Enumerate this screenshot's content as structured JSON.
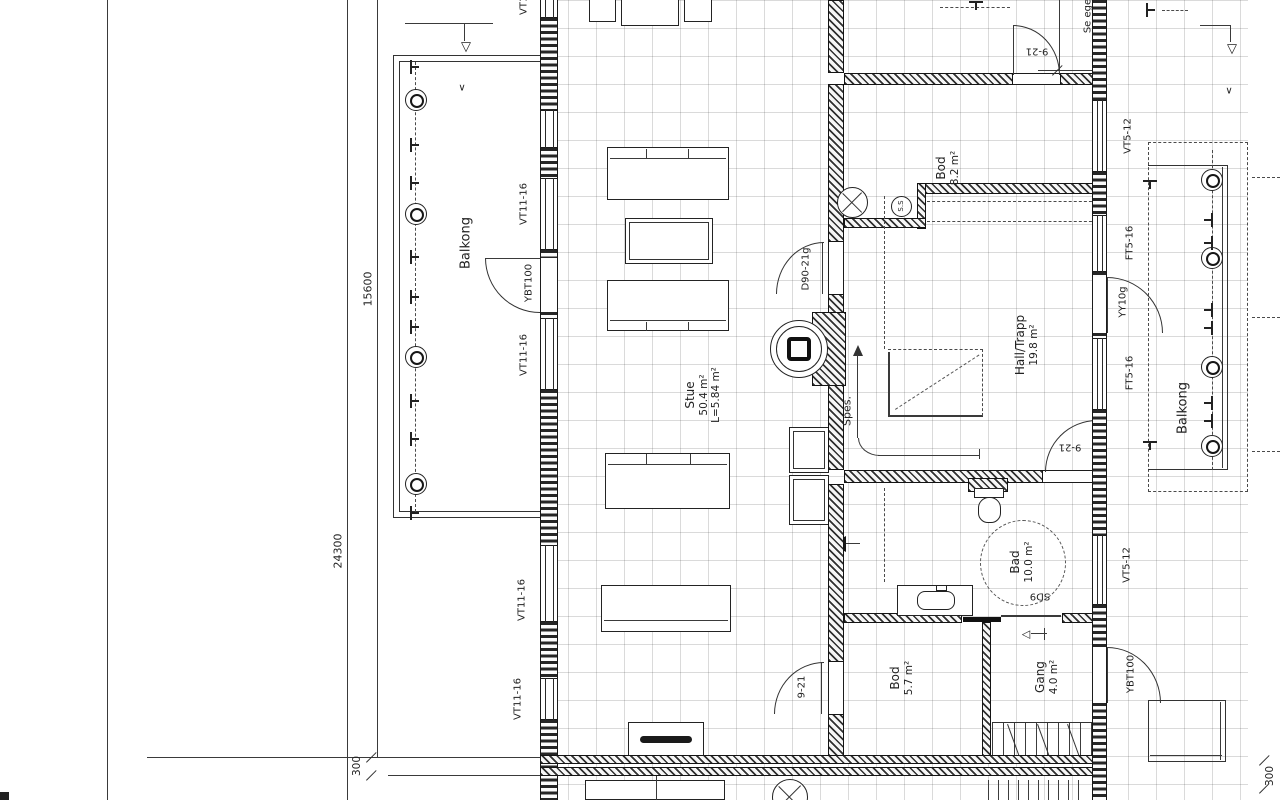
{
  "colors": {
    "ink": "#222222",
    "paper": "#ffffff"
  },
  "icons": {
    "section_triangle": "▽",
    "small_arrow": "∨",
    "entry_arrow": "◁"
  },
  "rooms": {
    "stue": {
      "name": "Stue",
      "area": "50.4 m²",
      "length": "L=5.84 m²"
    },
    "hall": {
      "name": "Hall/Trapp",
      "area": "19.8 m²"
    },
    "bod_upper": {
      "name": "Bod",
      "area": "8.2 m²"
    },
    "bad": {
      "name": "Bad",
      "area": "10.0 m²"
    },
    "bod_lower": {
      "name": "Bod",
      "area": "5.7 m²"
    },
    "gang": {
      "name": "Gang",
      "area": "4.0 m²"
    },
    "spes": {
      "name": "Spes."
    },
    "balkong_left": {
      "name": "Balkong"
    },
    "balkong_right": {
      "name": "Balkong"
    }
  },
  "openings": {
    "left_windows": [
      "VT11-16",
      "VT11-16",
      "VT11-16",
      "VT11-16",
      "VT11-16"
    ],
    "left_door": "YBT100",
    "d90": "D90-21g",
    "door_921_stue": "9-21",
    "door_921_hall": "9-21",
    "door_921_top": "9-21",
    "sliding_door": "SD9",
    "right_vt512_upper": "VT5-12",
    "right_ft516_upper": "FT5-16",
    "right_yy10g": "YY10g",
    "right_ft516_lower": "FT5-16",
    "right_vt512_lower": "VT5-12",
    "right_ybt100": "YBT100"
  },
  "dimensions": {
    "total_depth": "24300",
    "upper_depth": "15600",
    "eave_left": "300",
    "eave_right": "300"
  },
  "annotations": {
    "see_note": "Se ege",
    "ss_label": "S.S"
  }
}
